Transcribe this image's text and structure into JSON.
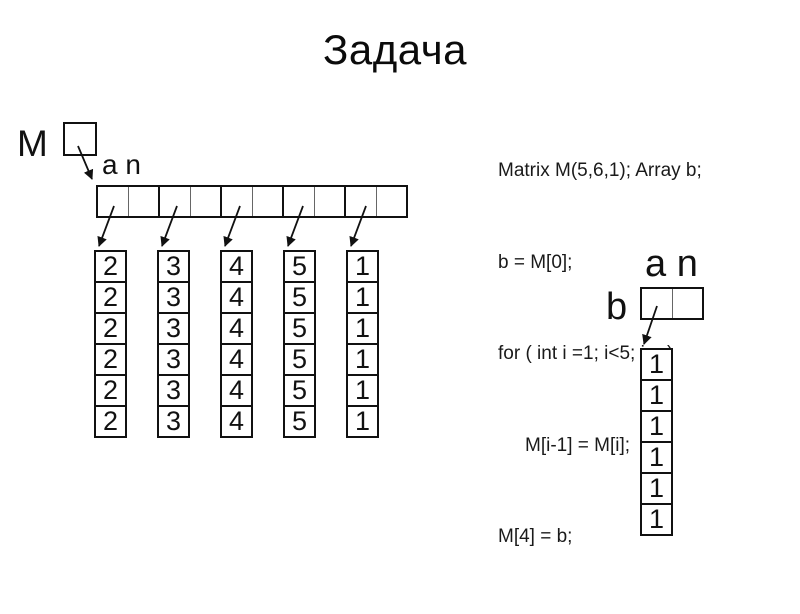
{
  "title": "Задача",
  "colors": {
    "ink": "#111111",
    "background": "#ffffff"
  },
  "code": {
    "lines": [
      "Matrix M(5,6,1); Array b;",
      "b = M[0];",
      "for ( int i =1; i<5; i++)",
      "M[i-1] = M[i];",
      "M[4] = b;"
    ]
  },
  "matrix": {
    "label": "M",
    "header": "a n",
    "pair_count": 5,
    "columns": [
      {
        "values": [
          "2",
          "2",
          "2",
          "2",
          "2",
          "2"
        ]
      },
      {
        "values": [
          "3",
          "3",
          "3",
          "3",
          "3",
          "3"
        ]
      },
      {
        "values": [
          "4",
          "4",
          "4",
          "4",
          "4",
          "4"
        ]
      },
      {
        "values": [
          "5",
          "5",
          "5",
          "5",
          "5",
          "5"
        ]
      },
      {
        "values": [
          "1",
          "1",
          "1",
          "1",
          "1",
          "1"
        ]
      }
    ]
  },
  "array_b": {
    "label": "b",
    "header": "a n",
    "values": [
      "1",
      "1",
      "1",
      "1",
      "1",
      "1"
    ]
  }
}
